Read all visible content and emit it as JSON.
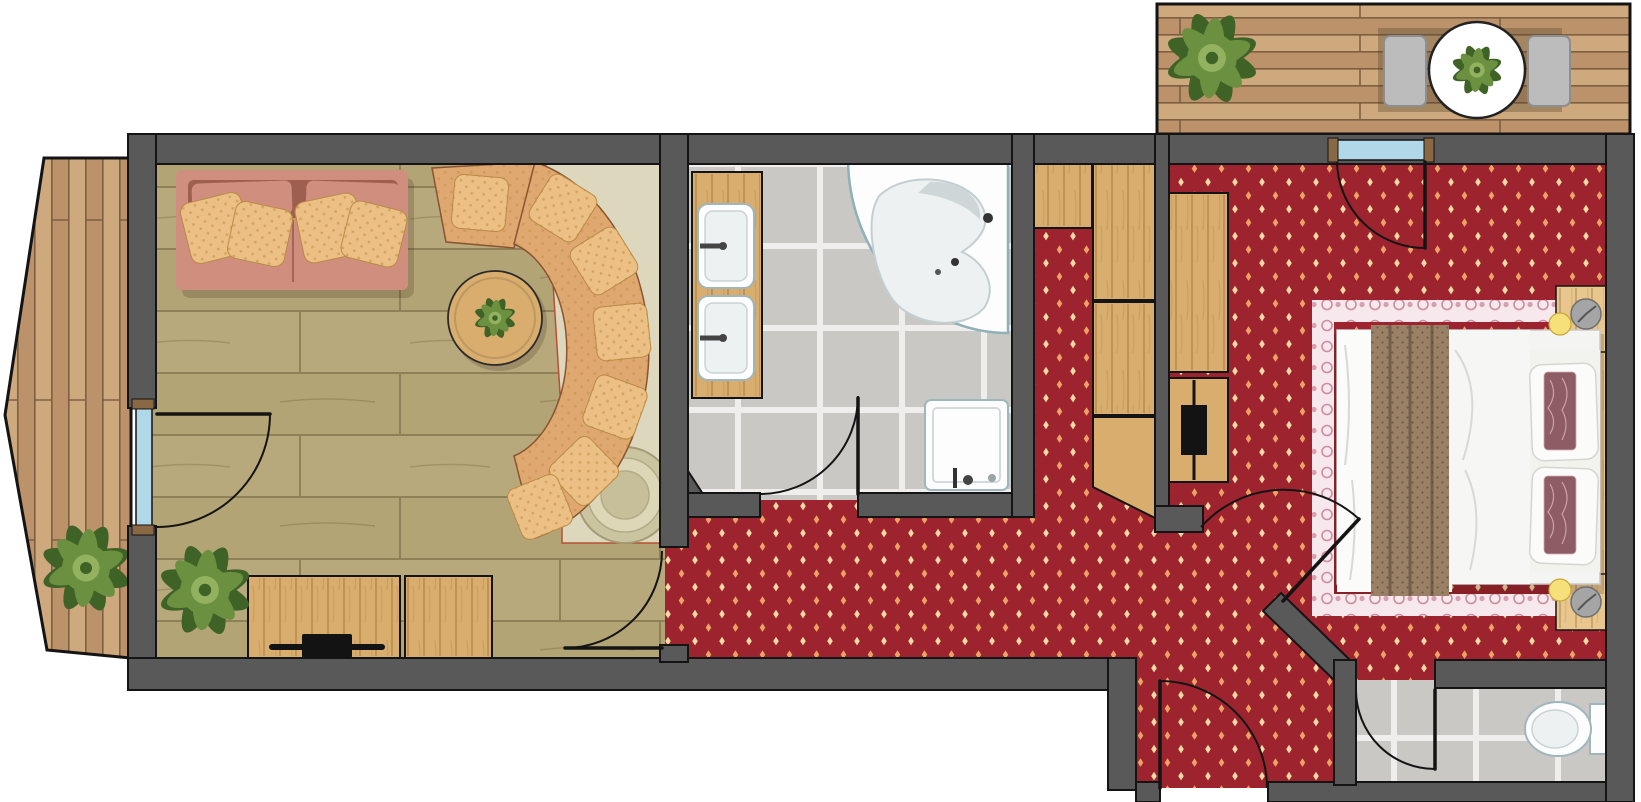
{
  "document": {
    "kind": "hotel-suite-floor-plan",
    "view": "top-down"
  },
  "colors": {
    "wall": "#595959",
    "wall_outline": "#141414",
    "door_arc": "#141414",
    "door_post": "#8a6844",
    "glazing": "#b0d8e8",
    "floor_wood_base": "#b2a474",
    "floor_wood_line": "#8e8057",
    "carpet_base": "#9d232e",
    "carpet_motif_a": "#eca265",
    "carpet_motif_b": "#f7d9a4",
    "tile_base": "#c9c8c5",
    "tile_grout": "#efeeec",
    "deck_a": "#cda97d",
    "deck_b": "#bb9269",
    "deck_line": "#7e5f42",
    "furniture_wood": "#d8ad6e",
    "headboard_wood": "#e8c68e",
    "sofa_base": "#cf8e7e",
    "sofa_dark": "#9e5f50",
    "pillow_gold": "#ecc084",
    "pillow_gold_dark": "#c2904a",
    "bench_fabric": "#e0a871",
    "platform_beige": "#ddd8bd",
    "platform_edge": "#b65030",
    "stove_outer": "#cbc4a0",
    "stove_mid": "#ddd7b8",
    "stove_inner": "#c6bf9a",
    "fixture_white": "#fdfdfd",
    "fixture_stroke": "#9fb6bc",
    "fixture_stroke2": "#c9d3d5",
    "fixture_shade": "#eef1f1",
    "throw_base": "#9a8166",
    "throw_dot": "#6f5c49",
    "accent_pillow": "#8d5c64",
    "accent_pillow_line": "#d3aab2",
    "border_base": "#f6e8ec",
    "border_motif": "#cf8da0",
    "chair_gray": "#bcbcbc",
    "chair_gray_dark": "#8e8e8e",
    "plant_dark": "#3f6226",
    "plant_mid": "#6b9040",
    "plant_light": "#93b25f",
    "lamp_glow": "#f5e07a",
    "lamp_edge": "#caa63c",
    "clock_gray": "#a5a5a5",
    "clock_edge": "#6e6e6e",
    "tv_black": "#131313"
  },
  "areas": {
    "balcony_left": {
      "floor": "wood-deck-vertical",
      "items": [
        "potted-plant"
      ]
    },
    "terrace_top_right": {
      "floor": "wood-deck-horizontal",
      "items": [
        "potted-plant",
        "round-table",
        "armchair",
        "armchair",
        "table-plant"
      ]
    },
    "living_room": {
      "floor": "wood-plank",
      "items": [
        "sofa",
        "sofa-pillows",
        "curved-bench",
        "bench-pillows",
        "round-coffee-table",
        "table-plant",
        "tiled-stove",
        "stove-platform",
        "sideboard-tv",
        "sideboard",
        "potted-plant",
        "balcony-door"
      ]
    },
    "bathroom": {
      "floor": "gray-tile",
      "items": [
        "vanity-counter",
        "sink",
        "sink",
        "corner-bathtub",
        "shower",
        "door"
      ]
    },
    "hallway": {
      "floor": "red-carpet",
      "items": [
        "wardrobe",
        "wardrobe-column",
        "entrance-door"
      ]
    },
    "bedroom": {
      "floor": "red-carpet",
      "items": [
        "double-bed",
        "bed-throw",
        "pillows",
        "accent-pillows",
        "rug-border",
        "headboard-panel",
        "nightstand",
        "nightstand",
        "lamp",
        "lamp",
        "clock",
        "clock",
        "wardrobe",
        "luggage-bench",
        "balcony-door"
      ]
    },
    "wc": {
      "floor": "gray-tile",
      "items": [
        "toilet",
        "door"
      ]
    }
  }
}
